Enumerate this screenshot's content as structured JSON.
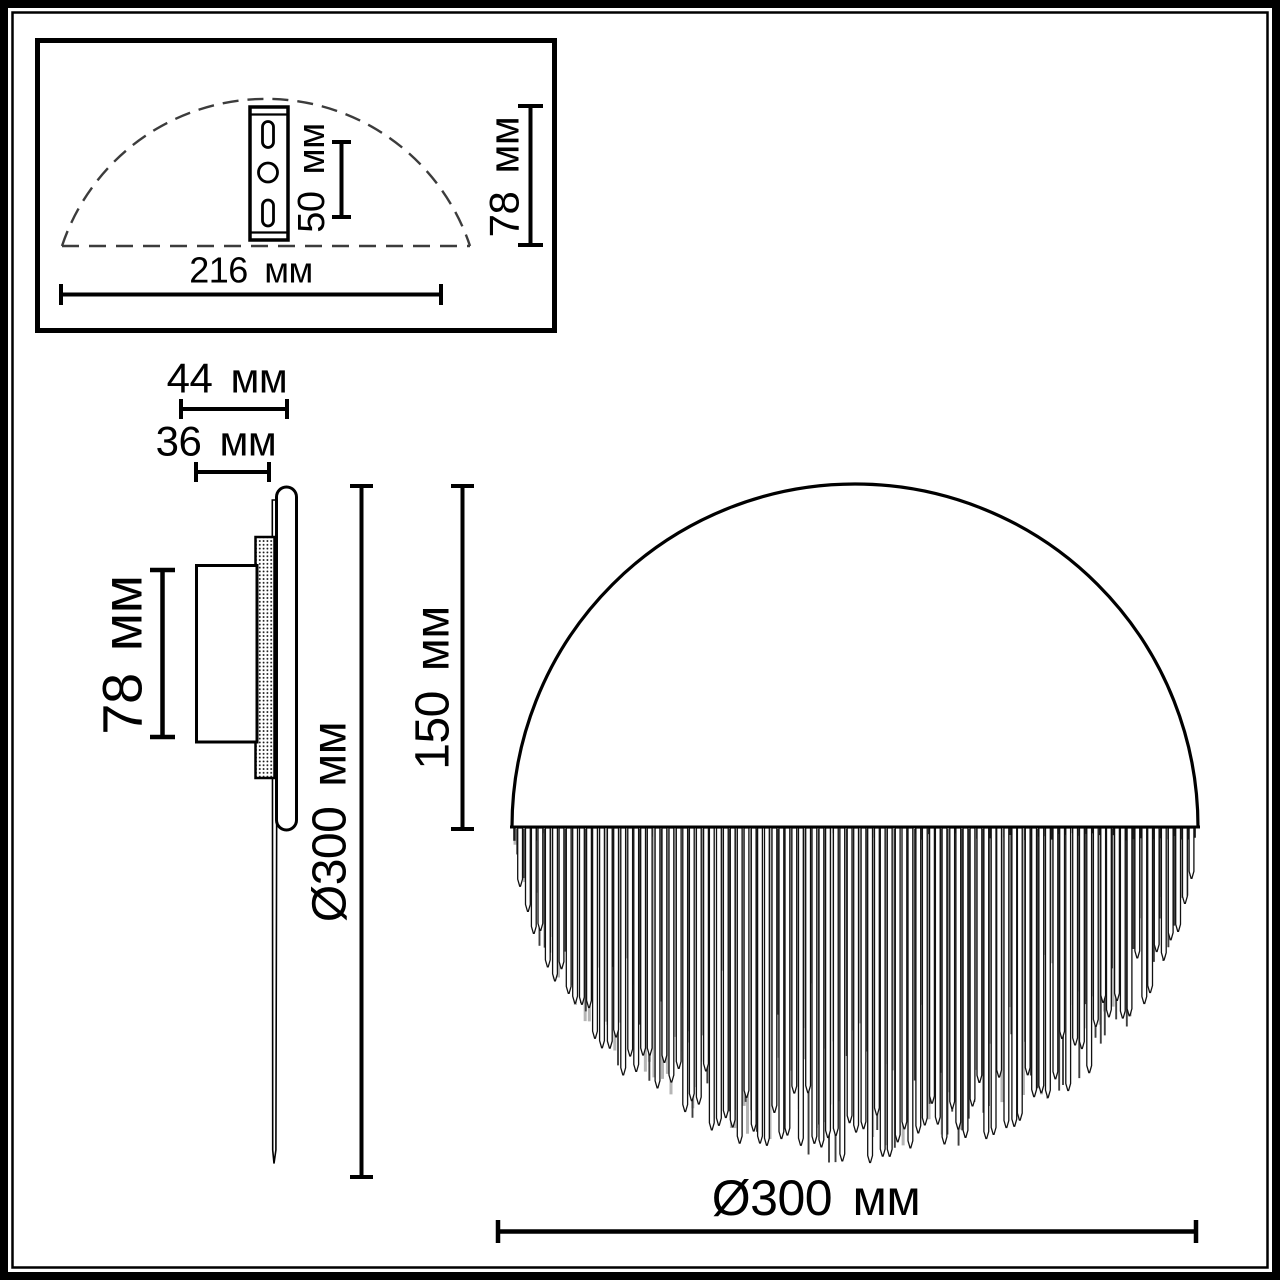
{
  "colors": {
    "line": "#000000",
    "background": "#ffffff",
    "dash": "#3c3c3c"
  },
  "inset_top_view": {
    "description": "top view with mounting bracket",
    "dim_slot_spacing": "50 мм",
    "dim_width": "216 мм",
    "dim_depth": "78 мм"
  },
  "side_view": {
    "description": "side profile of wall sconce",
    "dim_total_depth": "44 мм",
    "dim_plate_depth": "36 мм",
    "dim_mount_height": "78 мм",
    "dim_diameter": "Ø300 мм",
    "dim_radius_height": "150 мм"
  },
  "front_view": {
    "description": "front view, disc with hanging fringe",
    "dim_diameter": "Ø300 мм"
  },
  "dimensions_mm": {
    "slot_spacing": 50,
    "bracket_plate_width": 216,
    "body_depth": 78,
    "total_depth": 44,
    "plate_depth": 36,
    "diameter": 300,
    "radius_height": 150
  }
}
